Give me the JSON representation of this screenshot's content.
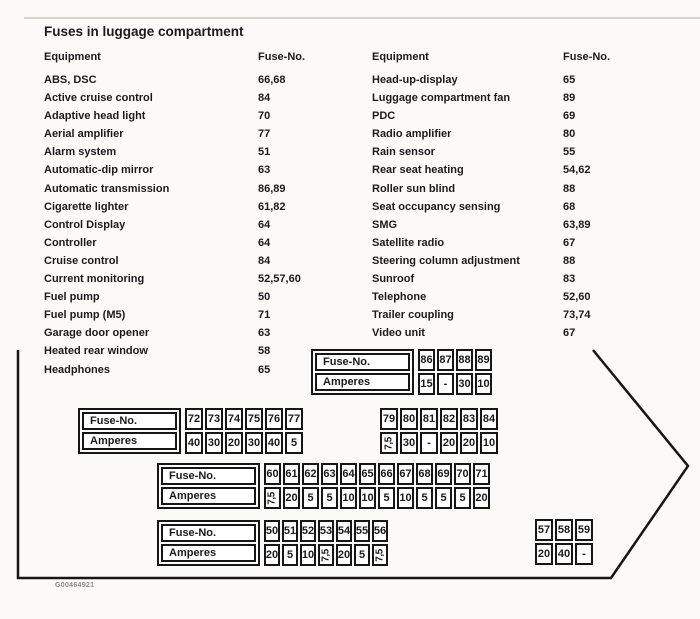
{
  "page": {
    "title": "Fuses in luggage compartment",
    "figure_code": "G00464921"
  },
  "equipment_table": {
    "headers": {
      "equipment_left": "Equipment",
      "fuse_no_left": "Fuse-No.",
      "equipment_right": "Equipment",
      "fuse_no_right": "Fuse-No."
    },
    "left_rows": [
      {
        "label": "ABS, DSC",
        "fuse": "66,68"
      },
      {
        "label": "Active cruise control",
        "fuse": "84"
      },
      {
        "label": "Adaptive head light",
        "fuse": "70"
      },
      {
        "label": "Aerial amplifier",
        "fuse": "77"
      },
      {
        "label": "Alarm system",
        "fuse": "51"
      },
      {
        "label": "Automatic-dip mirror",
        "fuse": "63"
      },
      {
        "label": "Automatic transmission",
        "fuse": "86,89"
      },
      {
        "label": "Cigarette lighter",
        "fuse": "61,82"
      },
      {
        "label": "Control Display",
        "fuse": "64"
      },
      {
        "label": "Controller",
        "fuse": "64"
      },
      {
        "label": "Cruise control",
        "fuse": "84"
      },
      {
        "label": "Current monitoring",
        "fuse": "52,57,60"
      },
      {
        "label": "Fuel pump",
        "fuse": "50"
      },
      {
        "label": "Fuel pump (M5)",
        "fuse": "71"
      },
      {
        "label": "Garage door opener",
        "fuse": "63"
      },
      {
        "label": "Heated rear window",
        "fuse": "58"
      },
      {
        "label": "Headphones",
        "fuse": "65"
      }
    ],
    "right_rows": [
      {
        "label": "Head-up-display",
        "fuse": "65"
      },
      {
        "label": "Luggage compartment fan",
        "fuse": "89"
      },
      {
        "label": "PDC",
        "fuse": "69"
      },
      {
        "label": "Radio amplifier",
        "fuse": "80"
      },
      {
        "label": "Rain sensor",
        "fuse": "55"
      },
      {
        "label": "Rear seat heating",
        "fuse": "54,62"
      },
      {
        "label": "Roller sun blind",
        "fuse": "88"
      },
      {
        "label": "Seat occupancy sensing",
        "fuse": "68"
      },
      {
        "label": "SMG",
        "fuse": "63,89"
      },
      {
        "label": "Satellite radio",
        "fuse": "67"
      },
      {
        "label": "Steering column adjustment",
        "fuse": "88"
      },
      {
        "label": "Sunroof",
        "fuse": "83"
      },
      {
        "label": "Telephone",
        "fuse": "52,60"
      },
      {
        "label": "Trailer coupling",
        "fuse": "73,74"
      },
      {
        "label": "Video unit",
        "fuse": "67"
      }
    ]
  },
  "fuse_amp_tables": {
    "row_labels": {
      "fuse_no": "Fuse-No.",
      "amperes": "Amperes"
    },
    "tables": [
      {
        "slot": "a",
        "has_label": true,
        "fuses": [
          "86",
          "87",
          "88",
          "89"
        ],
        "amperes": [
          "15",
          "-",
          "30",
          "10"
        ]
      },
      {
        "slot": "b",
        "has_label": true,
        "fuses": [
          "72",
          "73",
          "74",
          "75",
          "76",
          "77"
        ],
        "amperes": [
          "40",
          "30",
          "20",
          "30",
          "40",
          "5"
        ]
      },
      {
        "slot": "c",
        "has_label": false,
        "fuses": [
          "79",
          "80",
          "81",
          "82",
          "83",
          "84"
        ],
        "amperes": [
          "7,5",
          "30",
          "-",
          "20",
          "20",
          "10"
        ]
      },
      {
        "slot": "d",
        "has_label": true,
        "fuses": [
          "60",
          "61",
          "62",
          "63",
          "64",
          "65",
          "66",
          "67",
          "68",
          "69",
          "70",
          "71"
        ],
        "amperes": [
          "7,5",
          "20",
          "5",
          "5",
          "10",
          "10",
          "5",
          "10",
          "5",
          "5",
          "5",
          "20"
        ]
      },
      {
        "slot": "e",
        "has_label": true,
        "fuses": [
          "50",
          "51",
          "52",
          "53",
          "54",
          "55",
          "56"
        ],
        "amperes": [
          "20",
          "5",
          "10",
          "7,5",
          "20",
          "5",
          "7,5"
        ]
      },
      {
        "slot": "f",
        "has_label": false,
        "fuses": [
          "57",
          "58",
          "59"
        ],
        "amperes": [
          "20",
          "40",
          "-"
        ]
      }
    ]
  },
  "arrow_outline": {
    "color": "#161616",
    "points": "18,350 18,578 611,578 688,466 593,350"
  }
}
